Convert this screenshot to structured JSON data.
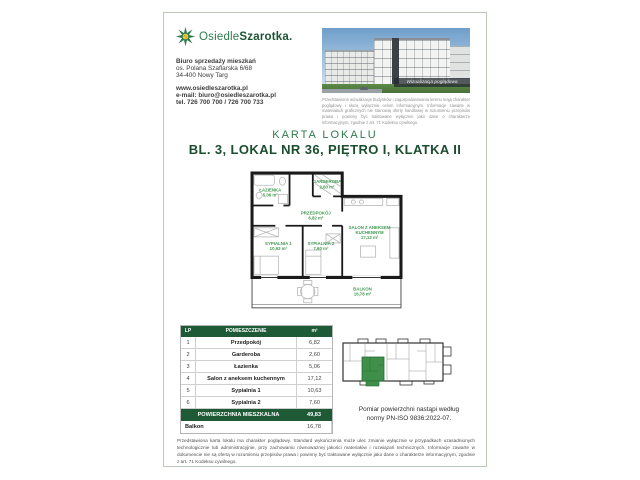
{
  "brand": {
    "name_part1": "Osiedle",
    "name_part2": "Szarotka.",
    "green": "#2e7a4d",
    "green_dark": "#1c5433",
    "yellow": "#f0c225"
  },
  "contact": {
    "office": "Biuro sprzedaży mieszkań",
    "address1": "os. Polana Szaflarska 6/68",
    "address2": "34-400 Nowy Targ",
    "website": "www.osiedleszarotka.pl",
    "email": "e-mail: biuro@osiedleszarotka.pl",
    "phone": "tel. 726 700 700 / 726 700 733"
  },
  "visual": {
    "caption": "Wizualizacja poglądowa",
    "note": "Przedstawione wizualizacje budynków i zagospodarowania terenu mają charakter poglądowy i służą wyłącznie celom informacyjnym. Informacje zawarte w materiałach graficznych nie stanowią oferty handlowej w rozumieniu przepisów prawa i powinny być traktowane wyłącznie jako dane o charakterze informacyjnym, zgodnie z art. 71 Kodeksu cywilnego."
  },
  "title": {
    "kicker": "KARTA LOKALU",
    "heading": "BL. 3, LOKAL NR 36, PIĘTRO I, KLATKA II"
  },
  "plan": {
    "label_color": "#3d9a4e",
    "labels": {
      "lazienka": {
        "name": "ŁAZIENKA",
        "area": "5,06 m²"
      },
      "przedpokoj": {
        "name": "PRZEDPOKÓJ",
        "area": "6,82 m²"
      },
      "garderoba": {
        "name": "GARDEROBA",
        "area": "2,60 m²"
      },
      "sypialnia1": {
        "name": "SYPIALNIA 1",
        "area": "10,63 m²"
      },
      "sypialnia2": {
        "name": "SYPIALNIA 2",
        "area": "7,60 m²"
      },
      "salon": {
        "name": "SALON Z ANEKSEM",
        "name2": "KUCHENNYM",
        "area": "17,12 m²"
      },
      "balkon": {
        "name": "BALKON",
        "area": "16,78 m²"
      }
    }
  },
  "table": {
    "header_bg": "#1d5a35",
    "headers": {
      "lp": "LP",
      "room": "POMIESZCZENIE",
      "unit": "m²"
    },
    "rows": [
      {
        "no": "1",
        "name": "Przedpokój",
        "area": "6,82"
      },
      {
        "no": "2",
        "name": "Garderoba",
        "area": "2,60"
      },
      {
        "no": "3",
        "name": "Łazienka",
        "area": "5,06"
      },
      {
        "no": "4",
        "name": "Salon z aneksem kuchennym",
        "area": "17,12"
      },
      {
        "no": "5",
        "name": "Sypialnia 1",
        "area": "10,63"
      },
      {
        "no": "6",
        "name": "Sypialnia 2",
        "area": "7,60"
      }
    ],
    "summary": {
      "label": "POWIERZCHNIA MIESZKALNA",
      "value": "49,83"
    },
    "balcony": {
      "label": "Balkon",
      "value": "16,78"
    }
  },
  "measurement_note": {
    "line1": "Pomiar powierzchni nastąpi według",
    "line2": "normy PN-ISO 9836:2022-07."
  },
  "footer_note": "Przedstawiona karta lokalu ma charakter poglądowy. Standard wykończenia może ulec zmianie wyłącznie w przypadkach uzasadnionych technologicznie lub administracyjnie, przy zachowaniu równoważnej jakości materiałów i rozwiązań technicznych. Informacje zawarte w dokumencie nie są ofertą w rozumieniu przepisów prawa i powinny być traktowane wyłącznie jako dane o charakterze informacyjnym, zgodnie z art. 71 Kodeksu cywilnego."
}
